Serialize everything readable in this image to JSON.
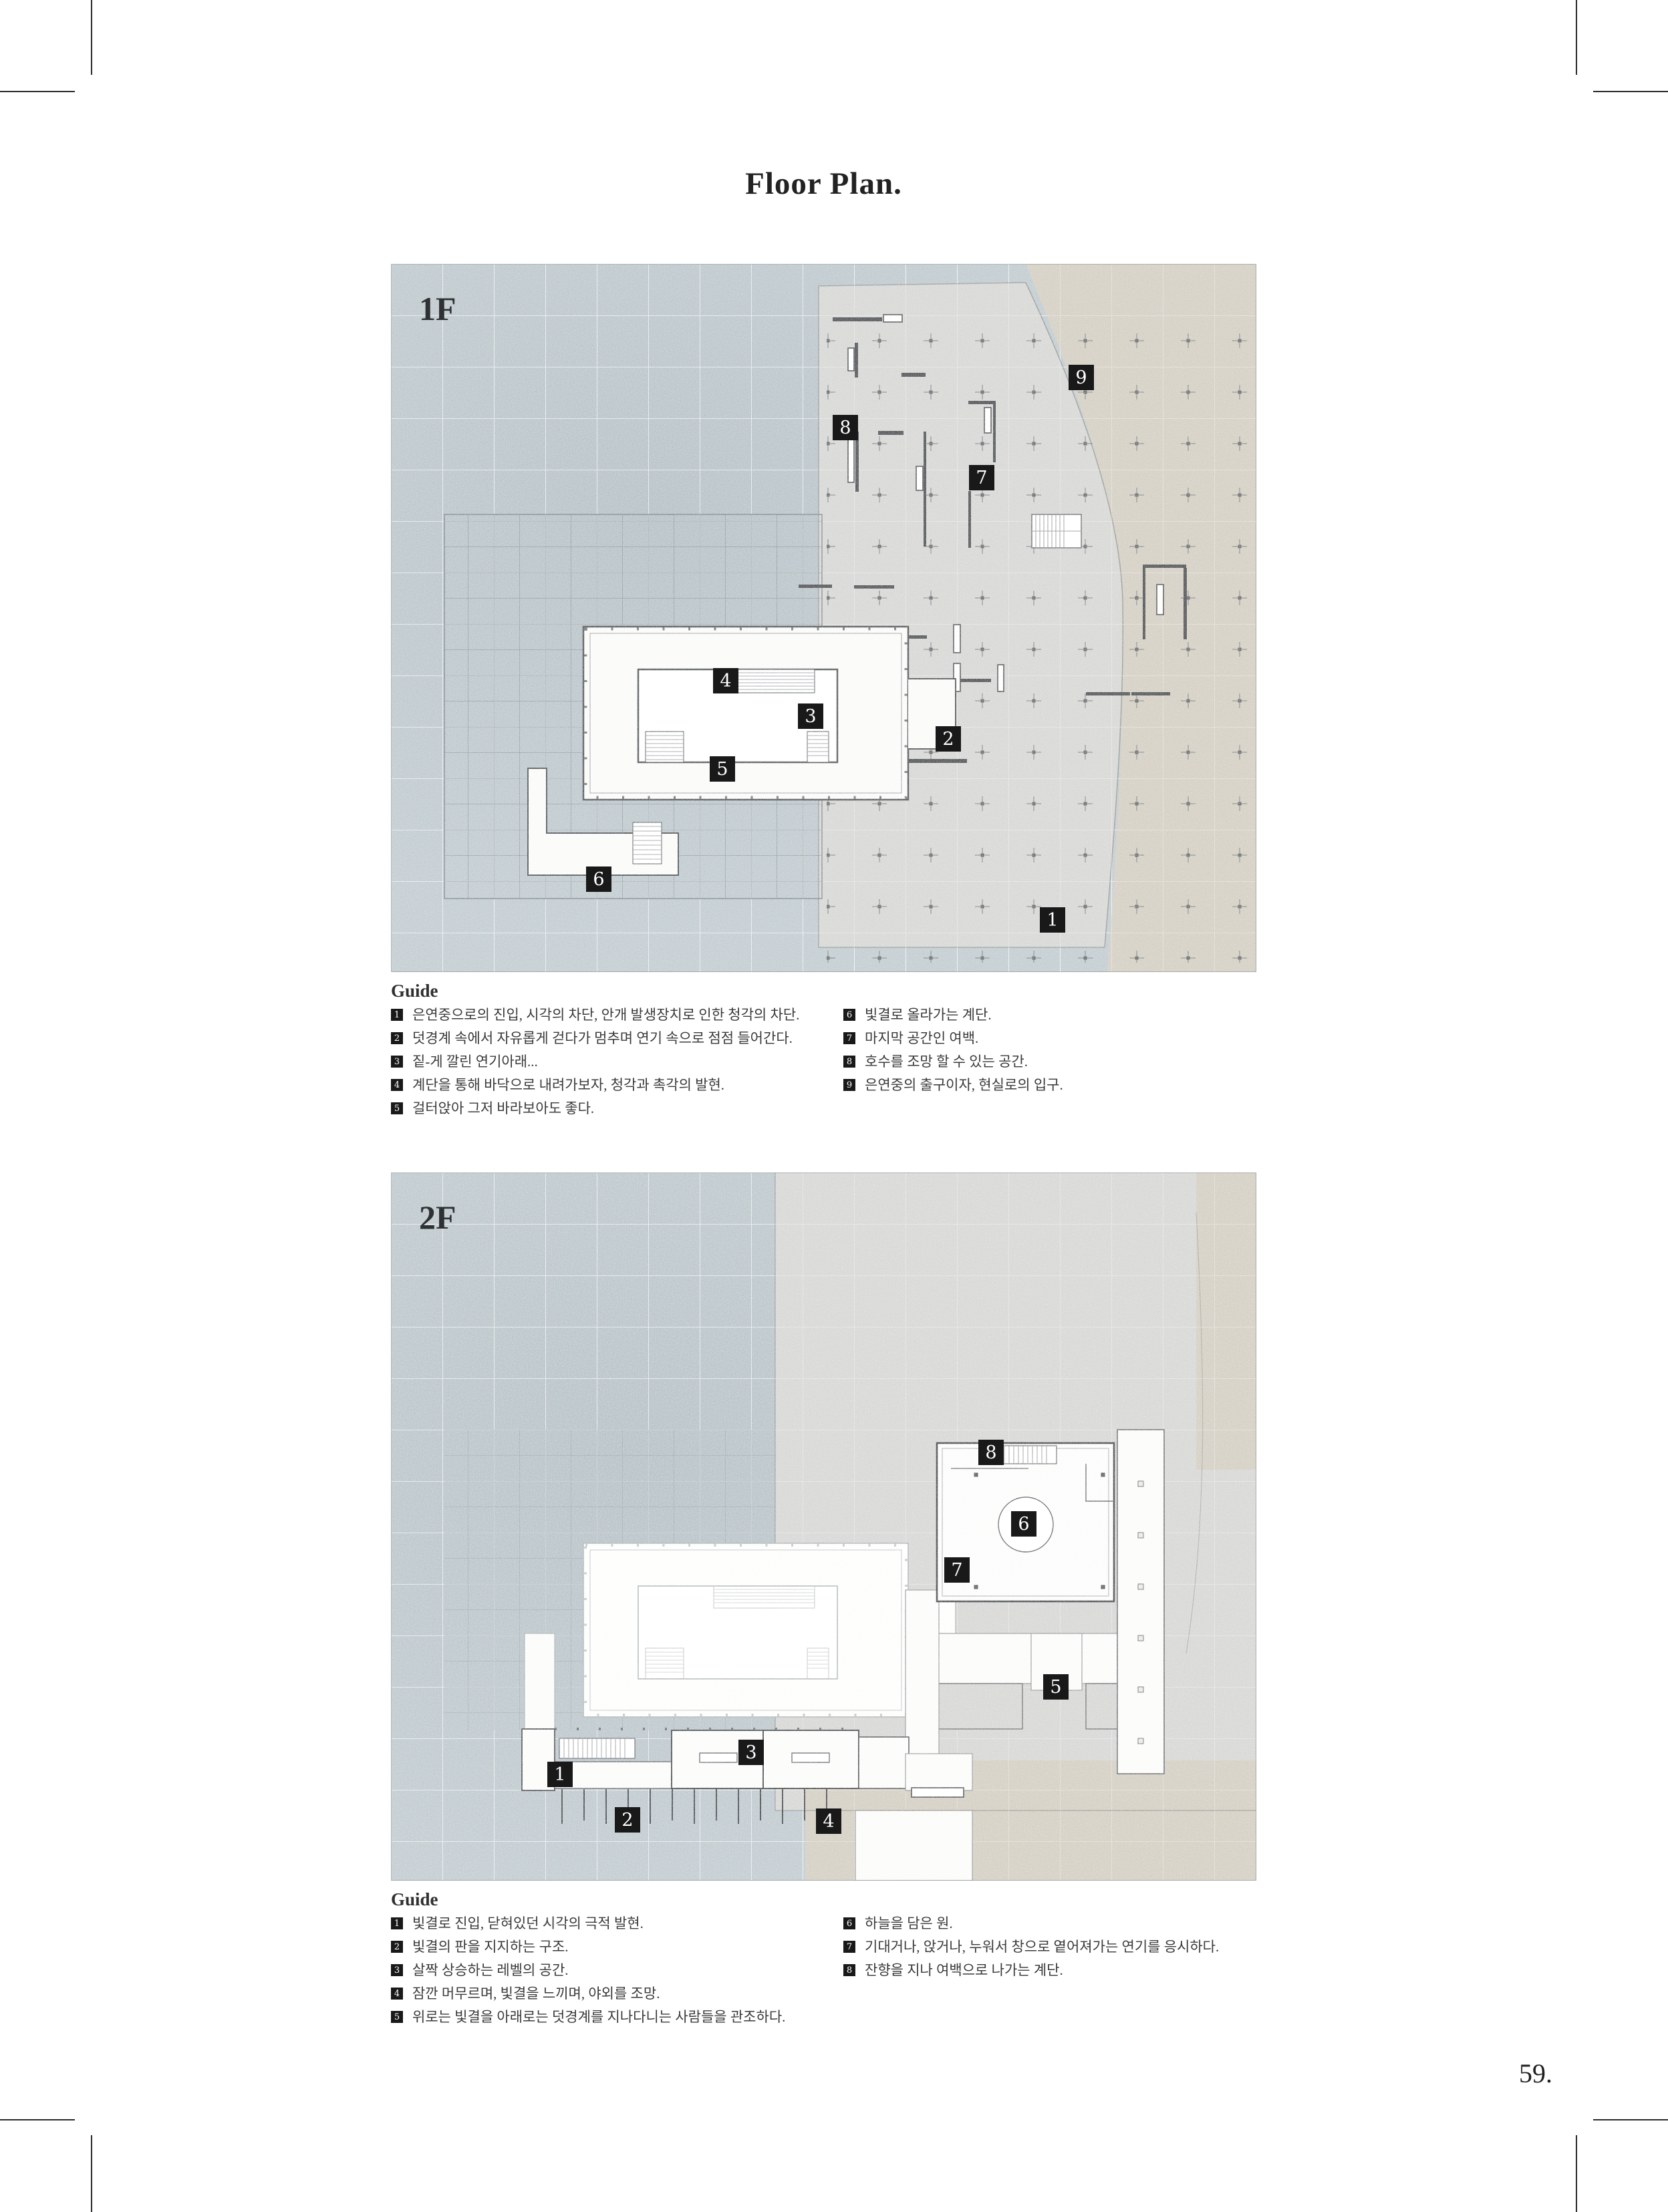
{
  "page": {
    "title": "Floor Plan.",
    "page_number": "59."
  },
  "floor1": {
    "label": "1F",
    "plan_markers": [
      "1",
      "2",
      "3",
      "4",
      "5",
      "6",
      "7",
      "8",
      "9"
    ],
    "guide": {
      "heading": "Guide",
      "left": [
        {
          "num": "1",
          "text": "은연중으로의 진입, 시각의 차단, 안개 발생장치로 인한 청각의 차단."
        },
        {
          "num": "2",
          "text": "덧경계 속에서 자유롭게 걷다가 멈추며 연기 속으로 점점 들어간다."
        },
        {
          "num": "3",
          "text": "짙-게 깔린 연기아래..."
        },
        {
          "num": "4",
          "text": "계단을 통해 바닥으로 내려가보자, 청각과 촉각의 발현."
        },
        {
          "num": "5",
          "text": "걸터앉아 그저 바라보아도 좋다."
        }
      ],
      "right": [
        {
          "num": "6",
          "text": "빛결로 올라가는 계단."
        },
        {
          "num": "7",
          "text": "마지막 공간인 여백."
        },
        {
          "num": "8",
          "text": "호수를 조망 할 수 있는 공간."
        },
        {
          "num": "9",
          "text": "은연중의 출구이자, 현실로의 입구."
        }
      ]
    }
  },
  "floor2": {
    "label": "2F",
    "plan_markers": [
      "1",
      "2",
      "3",
      "4",
      "5",
      "6",
      "7",
      "8"
    ],
    "guide": {
      "heading": "Guide",
      "left": [
        {
          "num": "1",
          "text": "빛결로 진입, 닫혀있던 시각의 극적 발현."
        },
        {
          "num": "2",
          "text": "빛결의 판을 지지하는 구조."
        },
        {
          "num": "3",
          "text": "살짝 상승하는 레벨의 공간."
        },
        {
          "num": "4",
          "text": "잠깐 머무르며, 빛결을 느끼며, 야외를 조망."
        },
        {
          "num": "5",
          "text": "위로는 빛결을 아래로는 덧경계를 지나다니는 사람들을 관조하다."
        }
      ],
      "right": [
        {
          "num": "6",
          "text": "하늘을 담은 원."
        },
        {
          "num": "7",
          "text": "기대거나, 앉거나, 누워서 창으로 옅어져가는 연기를 응시하다."
        },
        {
          "num": "8",
          "text": "잔향을 지나 여백으로 나가는 계단."
        }
      ]
    }
  },
  "colors": {
    "blue_gray": "#bbc6cb",
    "concrete_gray": "#d2d3d0",
    "beige": "#cfc9bc",
    "wall_dark": "#3f4245",
    "marker_bg": "#191919"
  }
}
